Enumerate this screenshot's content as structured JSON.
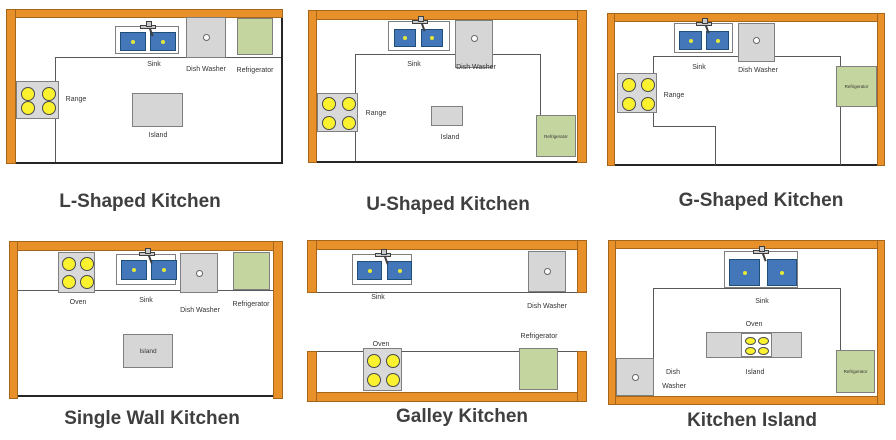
{
  "figure_title": "Kitchen layout types",
  "colors": {
    "counter_orange": "#E8912B",
    "sink_blue": "#4377B9",
    "burner_yellow": "#FAF22E",
    "refrigerator_green": "#C5D5A0",
    "appliance_gray": "#D6D6D6",
    "title_text": "#3F3F3F"
  },
  "diagrams": [
    {
      "title": "L-Shaped Kitchen",
      "labels": {
        "sink": "Sink",
        "dish_washer": "Dish Washer",
        "refrigerator": "Refrigerator",
        "range": "Range",
        "island": "Island"
      }
    },
    {
      "title": "U-Shaped Kitchen",
      "labels": {
        "sink": "Sink",
        "dish_washer": "Dish Washer",
        "range": "Range",
        "island": "Island",
        "refrigerator": "Refrigerator"
      }
    },
    {
      "title": "G-Shaped Kitchen",
      "labels": {
        "sink": "Sink",
        "dish_washer": "Dish Washer",
        "range": "Range",
        "refrigerator": "Refrigerator"
      }
    },
    {
      "title": "Single Wall Kitchen",
      "labels": {
        "oven": "Oven",
        "sink": "Sink",
        "dish_washer": "Dish Washer",
        "refrigerator": "Refrigerator",
        "island": "Island"
      }
    },
    {
      "title": "Galley Kitchen",
      "labels": {
        "sink": "Sink",
        "dish_washer": "Dish Washer",
        "oven": "Oven",
        "refrigerator": "Refrigerator"
      }
    },
    {
      "title": "Kitchen Island",
      "labels": {
        "sink": "Sink",
        "oven": "Oven",
        "island": "Island",
        "dish": "Dish",
        "washer": "Washer",
        "refrigerator": "Refrigerator"
      }
    }
  ]
}
